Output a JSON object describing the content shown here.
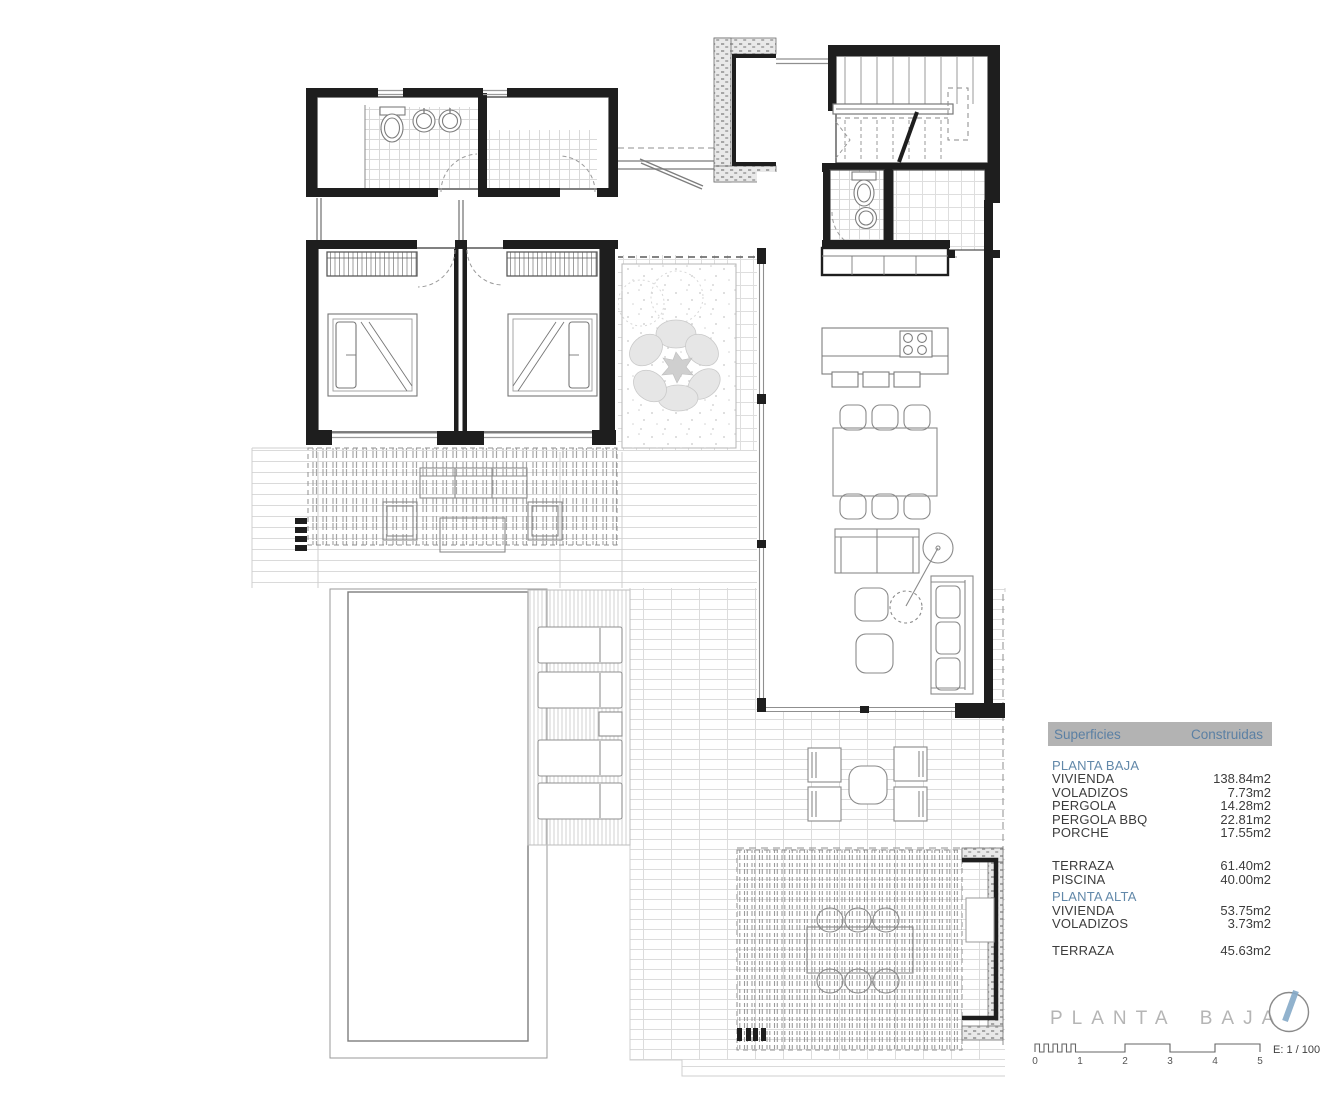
{
  "table": {
    "header": {
      "col1": "Superficies",
      "col2": "Construidas"
    },
    "rows": [
      {
        "type": "group",
        "label": "PLANTA BAJA",
        "value": ""
      },
      {
        "type": "item",
        "label": "VIVIENDA",
        "value": "138.84m2"
      },
      {
        "type": "item",
        "label": "VOLADIZOS",
        "value": "7.73m2"
      },
      {
        "type": "item",
        "label": "PERGOLA",
        "value": "14.28m2"
      },
      {
        "type": "item",
        "label": "PERGOLA BBQ",
        "value": "22.81m2"
      },
      {
        "type": "item",
        "label": "PORCHE",
        "value": "17.55m2"
      },
      {
        "type": "spacer"
      },
      {
        "type": "item",
        "label": "TERRAZA",
        "value": "61.40m2"
      },
      {
        "type": "item",
        "label": "PISCINA",
        "value": "40.00m2"
      },
      {
        "type": "group",
        "label": "PLANTA ALTA",
        "value": ""
      },
      {
        "type": "item",
        "label": "VIVIENDA",
        "value": "53.75m2"
      },
      {
        "type": "item",
        "label": "VOLADIZOS",
        "value": "3.73m2"
      },
      {
        "type": "spacer",
        "size": "small"
      },
      {
        "type": "item",
        "label": "TERRAZA",
        "value": "45.63m2"
      }
    ]
  },
  "title": {
    "text": "PLANTA BAJA"
  },
  "scale": {
    "ticks": [
      "0",
      "1",
      "2",
      "3",
      "4",
      "5"
    ],
    "label": "E: 1 / 100"
  },
  "colors": {
    "wall": "#1e1e1e",
    "accent_blue": "#5b80a4",
    "header_bg": "#b3b3b3",
    "title_gray": "#b5b5b5",
    "compass_needle": "#86aac8"
  }
}
